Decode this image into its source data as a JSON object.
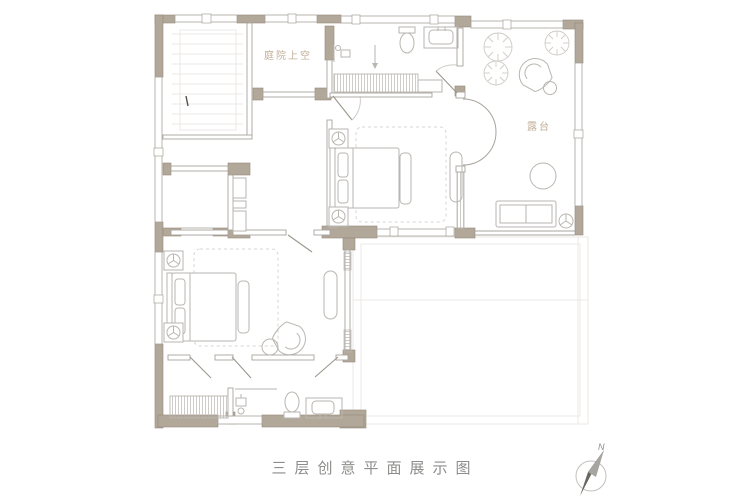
{
  "title": "三层创意平面展示图",
  "labels": {
    "courtyard_void": "庭院上空",
    "terrace": "露台",
    "compass_north": "N"
  },
  "colors": {
    "wall_fill": "#b2a899",
    "wall_stroke": "#94897a",
    "line": "#a8a49c",
    "furn": "#b9b6b0",
    "rug": "#d8d5d0",
    "faint": "#ebe9e5",
    "label": "#c1ae97",
    "title": "#8d8d8b",
    "compass": "#67665f"
  }
}
